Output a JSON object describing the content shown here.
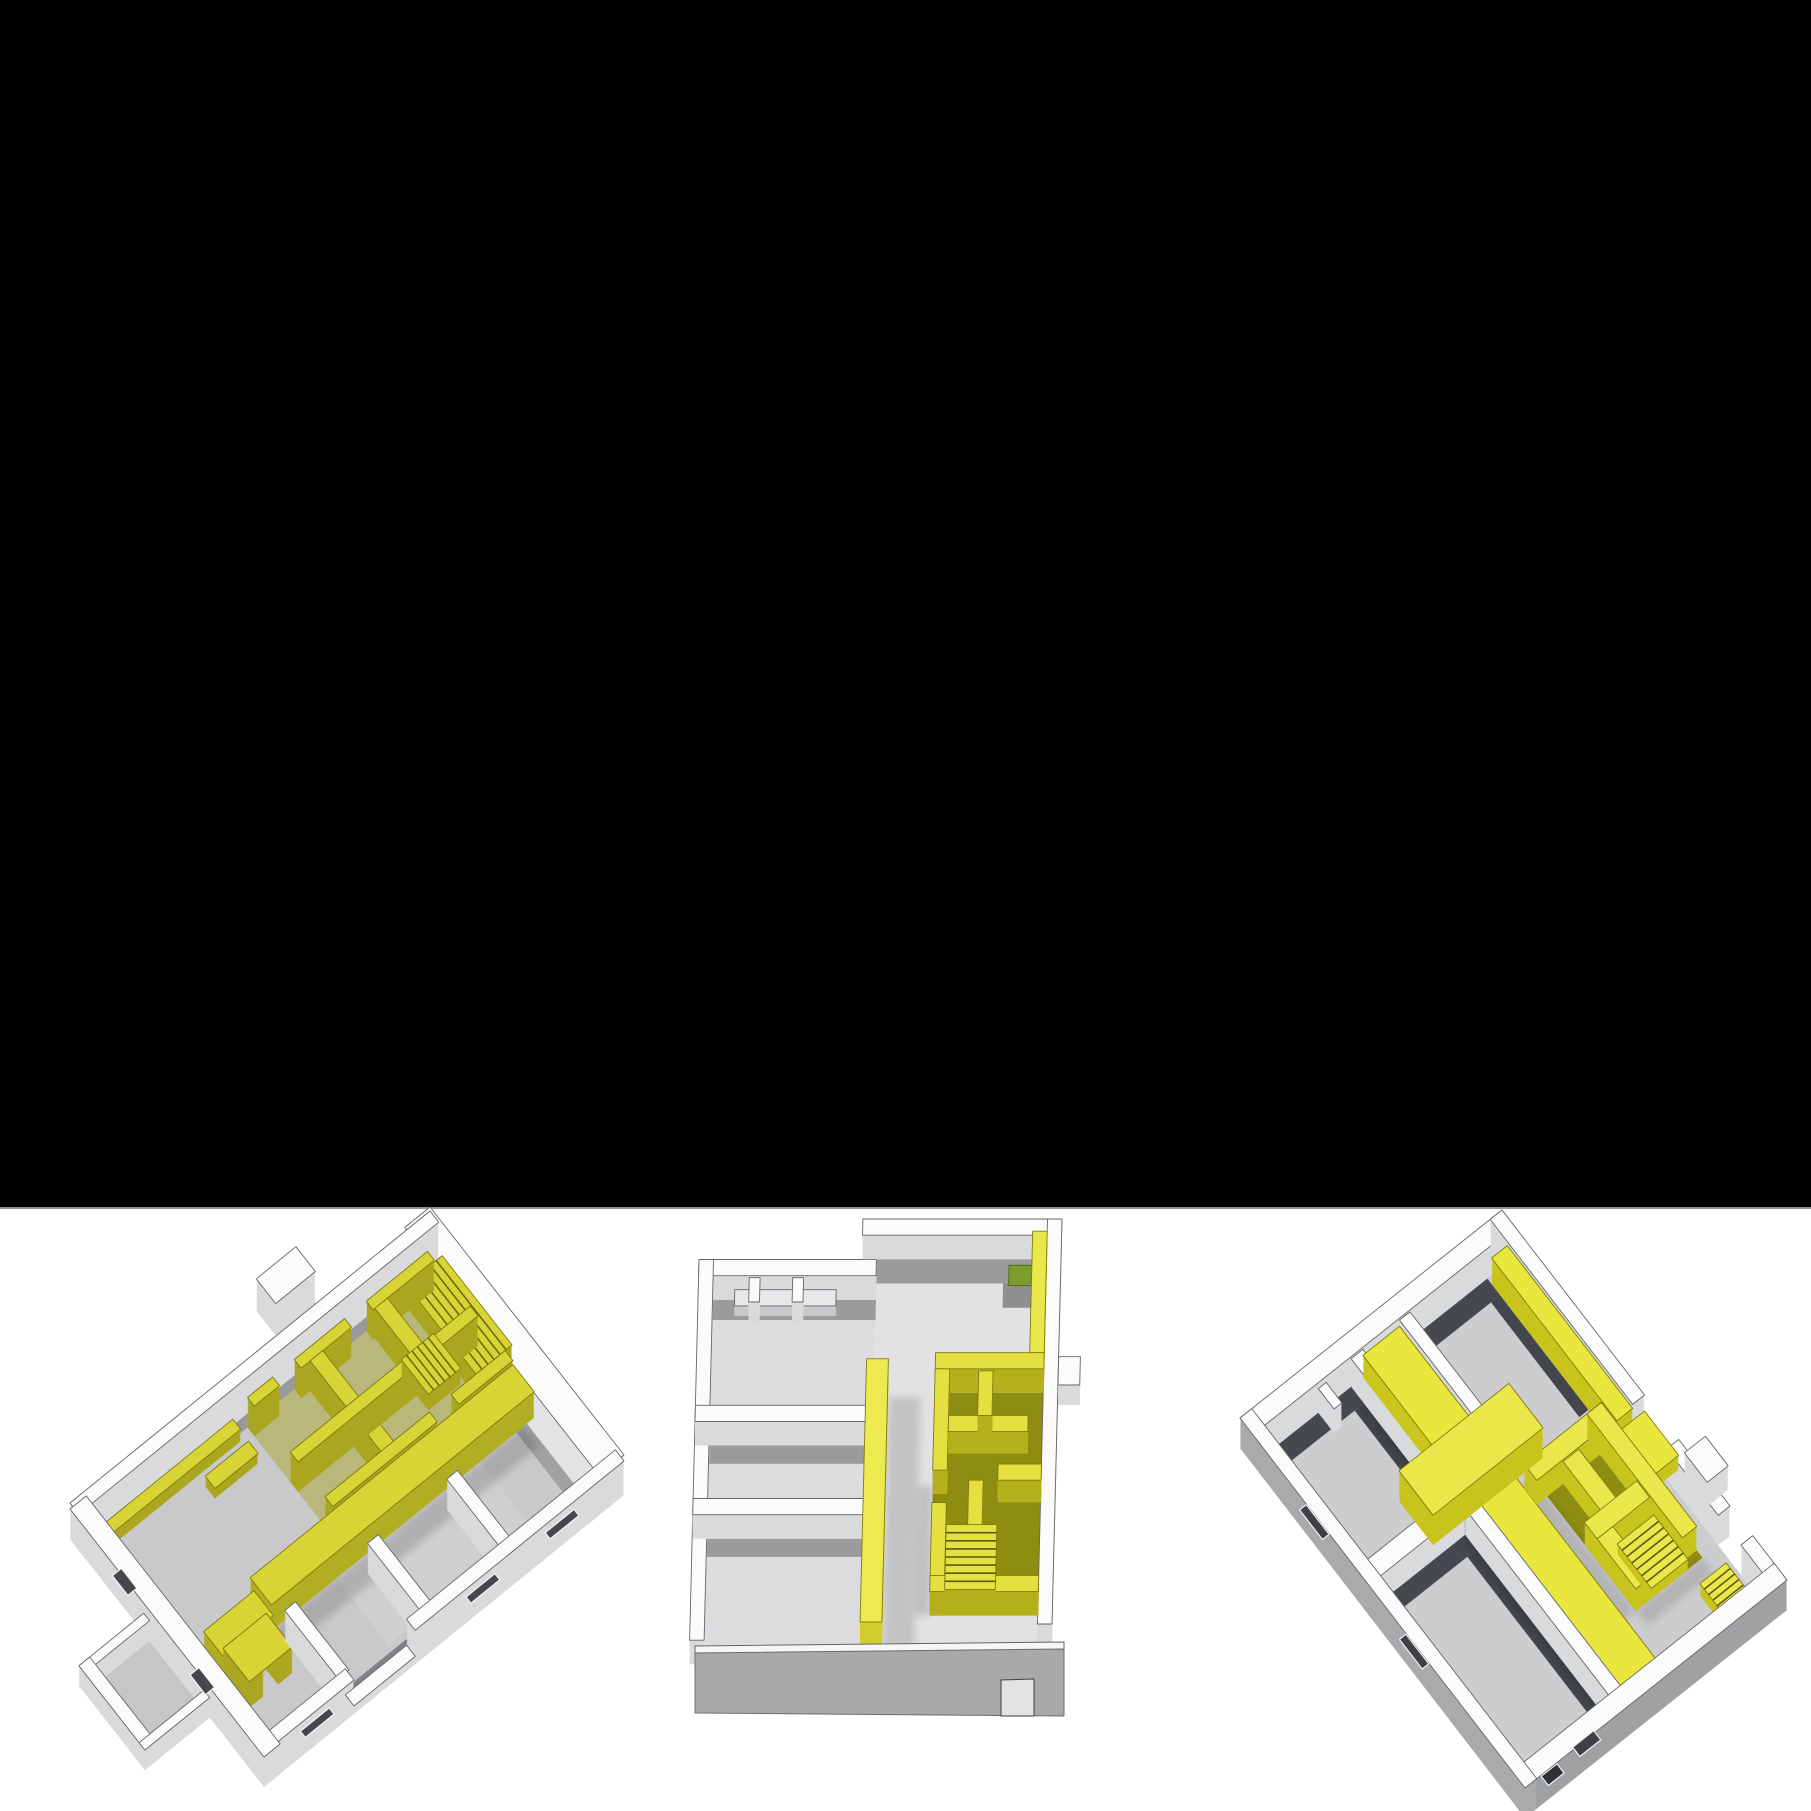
{
  "page": {
    "backdrop_color": "#000000",
    "strip_color": "#ffffff",
    "divider_color": "#8e9094"
  },
  "figure": {
    "models": [
      {
        "label": "3D axonometric floor plan model, tilted left, yellow highlighted partition walls and shelving"
      },
      {
        "label": "3D axonometric floor plan model, frontal view, yellow corridor wall, stair core and green planter"
      },
      {
        "label": "3D axonometric floor plan model, rotated right, yellow corridor band, service walls and stairs"
      }
    ],
    "palette": {
      "highlight_yellow": "#e9e63e",
      "olive_interior": "#8f8c12",
      "wall_white": "#fbfbfc",
      "floor_gray": "#cdcdcf",
      "dark_wall_gray": "#45484e",
      "plant_green": "#7d9c30"
    }
  }
}
